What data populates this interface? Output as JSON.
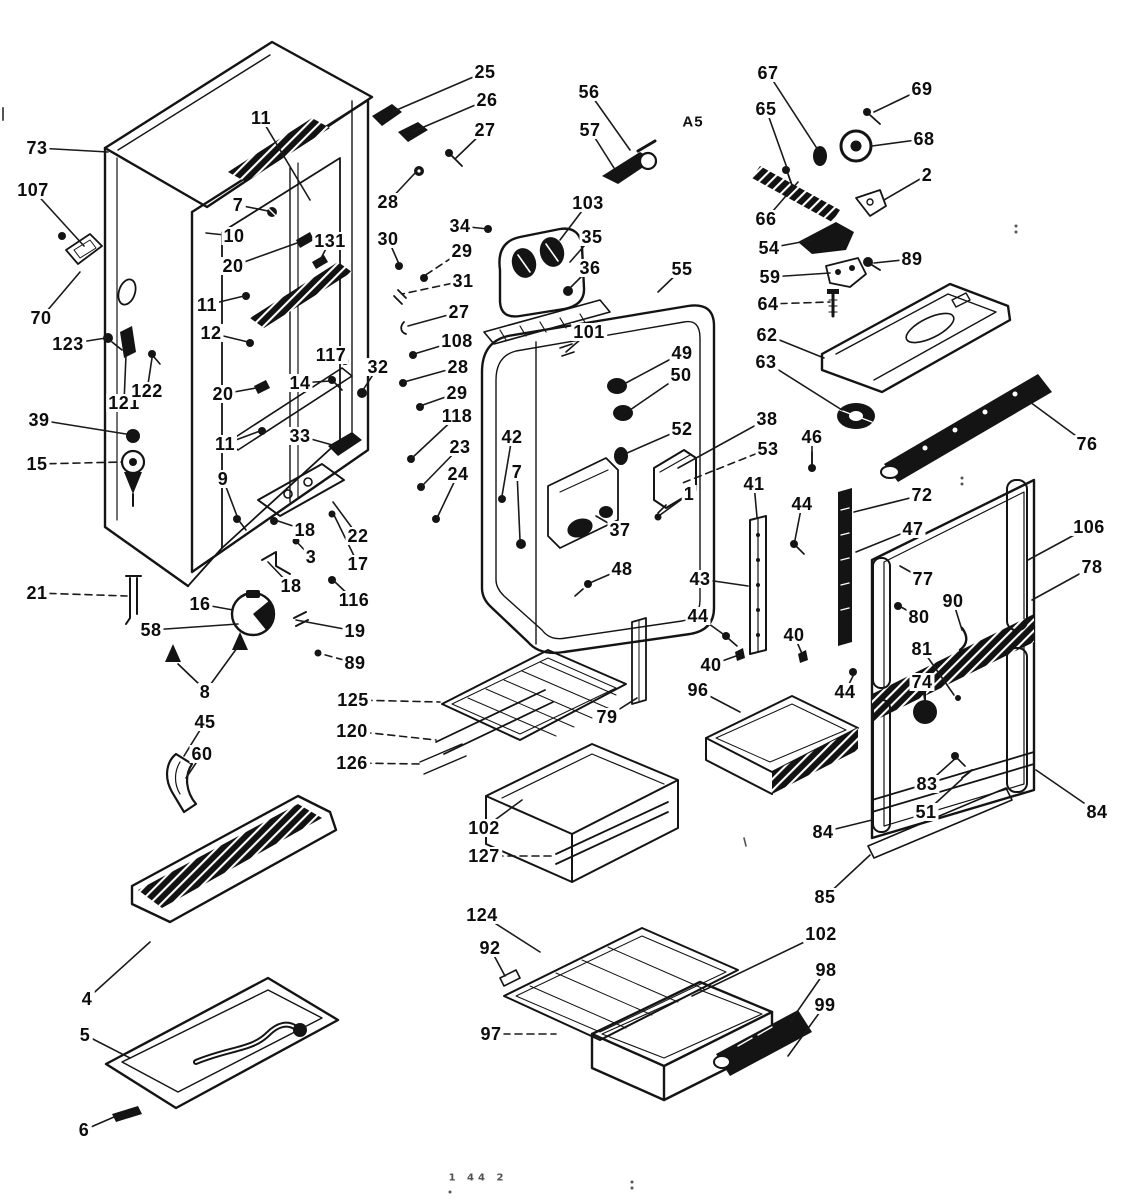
{
  "meta": {
    "sheet_code": "A5",
    "footer_note": "1 44 2",
    "description": "Refrigerator cabinet exploded parts diagram"
  },
  "diagram": {
    "labels": [
      {
        "t": "73",
        "x": 37,
        "y": 148,
        "lx": 108,
        "ly": 152,
        "d": false
      },
      {
        "t": "107",
        "x": 33,
        "y": 190,
        "lx": 84,
        "ly": 246,
        "d": false
      },
      {
        "t": "70",
        "x": 41,
        "y": 318,
        "lx": 80,
        "ly": 272,
        "d": false
      },
      {
        "t": "123",
        "x": 68,
        "y": 344,
        "lx": 106,
        "ly": 338,
        "d": false
      },
      {
        "t": "121",
        "x": 124,
        "y": 403,
        "lx": 126,
        "ly": 355,
        "d": false
      },
      {
        "t": "122",
        "x": 147,
        "y": 391,
        "lx": 152,
        "ly": 358,
        "d": false
      },
      {
        "t": "39",
        "x": 39,
        "y": 420,
        "lx": 126,
        "ly": 434,
        "d": false
      },
      {
        "t": "15",
        "x": 37,
        "y": 464,
        "lx": 122,
        "ly": 462,
        "d": true
      },
      {
        "t": "21",
        "x": 37,
        "y": 593,
        "lx": 127,
        "ly": 596,
        "d": true
      },
      {
        "t": "11",
        "x": 261,
        "y": 118,
        "lx": 310,
        "ly": 200,
        "d": false
      },
      {
        "t": "7",
        "x": 238,
        "y": 205,
        "lx": 268,
        "ly": 211,
        "d": false
      },
      {
        "t": "10",
        "x": 234,
        "y": 236,
        "lx": 206,
        "ly": 233,
        "d": false
      },
      {
        "t": "20",
        "x": 233,
        "y": 266,
        "lx": 297,
        "ly": 243,
        "d": false
      },
      {
        "t": "131",
        "x": 330,
        "y": 241,
        "lx": 318,
        "ly": 264,
        "d": false
      },
      {
        "t": "11",
        "x": 207,
        "y": 305,
        "lx": 244,
        "ly": 296,
        "d": false
      },
      {
        "t": "12",
        "x": 211,
        "y": 333,
        "lx": 248,
        "ly": 342,
        "d": false
      },
      {
        "t": "117",
        "x": 331,
        "y": 355,
        "lx": 344,
        "ly": 360,
        "d": false
      },
      {
        "t": "32",
        "x": 378,
        "y": 367,
        "lx": 363,
        "ly": 390,
        "d": false
      },
      {
        "t": "14",
        "x": 300,
        "y": 383,
        "lx": 330,
        "ly": 381,
        "d": false
      },
      {
        "t": "20",
        "x": 223,
        "y": 394,
        "lx": 256,
        "ly": 388,
        "d": false
      },
      {
        "t": "33",
        "x": 300,
        "y": 436,
        "lx": 336,
        "ly": 446,
        "d": false
      },
      {
        "t": "11",
        "x": 225,
        "y": 444,
        "lx": 260,
        "ly": 431,
        "d": false
      },
      {
        "t": "9",
        "x": 223,
        "y": 479,
        "lx": 237,
        "ly": 516,
        "d": false
      },
      {
        "t": "25",
        "x": 485,
        "y": 72,
        "lx": 392,
        "ly": 112,
        "d": false
      },
      {
        "t": "26",
        "x": 487,
        "y": 100,
        "lx": 412,
        "ly": 132,
        "d": false
      },
      {
        "t": "27",
        "x": 485,
        "y": 130,
        "lx": 456,
        "ly": 158,
        "d": false
      },
      {
        "t": "28",
        "x": 388,
        "y": 202,
        "lx": 416,
        "ly": 172,
        "d": false
      },
      {
        "t": "30",
        "x": 388,
        "y": 239,
        "lx": 399,
        "ly": 264,
        "d": false
      },
      {
        "t": "34",
        "x": 460,
        "y": 226,
        "lx": 488,
        "ly": 229,
        "d": false
      },
      {
        "t": "29",
        "x": 462,
        "y": 251,
        "lx": 424,
        "ly": 276,
        "d": true
      },
      {
        "t": "31",
        "x": 463,
        "y": 281,
        "lx": 402,
        "ly": 294,
        "d": true
      },
      {
        "t": "27",
        "x": 459,
        "y": 312,
        "lx": 408,
        "ly": 326,
        "d": false
      },
      {
        "t": "108",
        "x": 457,
        "y": 341,
        "lx": 414,
        "ly": 354,
        "d": false
      },
      {
        "t": "28",
        "x": 458,
        "y": 367,
        "lx": 404,
        "ly": 382,
        "d": false
      },
      {
        "t": "29",
        "x": 457,
        "y": 393,
        "lx": 420,
        "ly": 406,
        "d": false
      },
      {
        "t": "118",
        "x": 457,
        "y": 416,
        "lx": 412,
        "ly": 458,
        "d": false
      },
      {
        "t": "23",
        "x": 460,
        "y": 447,
        "lx": 422,
        "ly": 486,
        "d": false
      },
      {
        "t": "24",
        "x": 458,
        "y": 474,
        "lx": 437,
        "ly": 518,
        "d": false
      },
      {
        "t": "42",
        "x": 512,
        "y": 437,
        "lx": 502,
        "ly": 496,
        "d": false
      },
      {
        "t": "7",
        "x": 517,
        "y": 472,
        "lx": 520,
        "ly": 540,
        "d": false
      },
      {
        "t": "56",
        "x": 589,
        "y": 92,
        "lx": 630,
        "ly": 150,
        "d": false
      },
      {
        "t": "57",
        "x": 590,
        "y": 130,
        "lx": 614,
        "ly": 168,
        "d": false
      },
      {
        "t": "103",
        "x": 588,
        "y": 203,
        "lx": 560,
        "ly": 240,
        "d": false
      },
      {
        "t": "35",
        "x": 592,
        "y": 237,
        "lx": 570,
        "ly": 262,
        "d": false
      },
      {
        "t": "36",
        "x": 590,
        "y": 268,
        "lx": 568,
        "ly": 290,
        "d": false
      },
      {
        "t": "101",
        "x": 589,
        "y": 332,
        "lx": 566,
        "ly": 352,
        "d": false
      },
      {
        "t": "55",
        "x": 682,
        "y": 269,
        "lx": 658,
        "ly": 292,
        "d": false
      },
      {
        "t": "49",
        "x": 682,
        "y": 353,
        "lx": 624,
        "ly": 384,
        "d": false
      },
      {
        "t": "50",
        "x": 681,
        "y": 375,
        "lx": 630,
        "ly": 410,
        "d": false
      },
      {
        "t": "52",
        "x": 682,
        "y": 429,
        "lx": 627,
        "ly": 453,
        "d": false
      },
      {
        "t": "38",
        "x": 767,
        "y": 419,
        "lx": 678,
        "ly": 468,
        "d": false
      },
      {
        "t": "53",
        "x": 768,
        "y": 449,
        "lx": 680,
        "ly": 484,
        "d": true
      },
      {
        "t": "1",
        "x": 689,
        "y": 494,
        "lx": 660,
        "ly": 515,
        "d": false
      },
      {
        "t": "37",
        "x": 620,
        "y": 530,
        "lx": 596,
        "ly": 516,
        "d": false
      },
      {
        "t": "48",
        "x": 622,
        "y": 569,
        "lx": 592,
        "ly": 582,
        "d": false
      },
      {
        "t": "67",
        "x": 768,
        "y": 73,
        "lx": 818,
        "ly": 150,
        "d": false
      },
      {
        "t": "65",
        "x": 766,
        "y": 109,
        "lx": 787,
        "ly": 168,
        "d": false
      },
      {
        "t": "69",
        "x": 922,
        "y": 89,
        "lx": 874,
        "ly": 112,
        "d": false
      },
      {
        "t": "68",
        "x": 924,
        "y": 139,
        "lx": 872,
        "ly": 146,
        "d": false
      },
      {
        "t": "2",
        "x": 927,
        "y": 175,
        "lx": 884,
        "ly": 200,
        "d": false
      },
      {
        "t": "66",
        "x": 766,
        "y": 219,
        "lx": 798,
        "ly": 182,
        "d": false
      },
      {
        "t": "54",
        "x": 769,
        "y": 248,
        "lx": 812,
        "ly": 240,
        "d": false
      },
      {
        "t": "89",
        "x": 912,
        "y": 259,
        "lx": 874,
        "ly": 263,
        "d": false
      },
      {
        "t": "59",
        "x": 770,
        "y": 277,
        "lx": 830,
        "ly": 273,
        "d": false
      },
      {
        "t": "64",
        "x": 768,
        "y": 304,
        "lx": 830,
        "ly": 302,
        "d": true
      },
      {
        "t": "62",
        "x": 767,
        "y": 335,
        "lx": 824,
        "ly": 358,
        "d": false
      },
      {
        "t": "63",
        "x": 766,
        "y": 362,
        "lx": 842,
        "ly": 410,
        "d": false
      },
      {
        "t": "76",
        "x": 1087,
        "y": 444,
        "lx": 1030,
        "ly": 402,
        "d": false
      },
      {
        "t": "46",
        "x": 812,
        "y": 437,
        "lx": 812,
        "ly": 464,
        "d": false
      },
      {
        "t": "41",
        "x": 754,
        "y": 484,
        "lx": 757,
        "ly": 517,
        "d": false
      },
      {
        "t": "44",
        "x": 802,
        "y": 504,
        "lx": 795,
        "ly": 540,
        "d": false
      },
      {
        "t": "72",
        "x": 922,
        "y": 495,
        "lx": 854,
        "ly": 512,
        "d": false
      },
      {
        "t": "47",
        "x": 913,
        "y": 529,
        "lx": 856,
        "ly": 552,
        "d": false
      },
      {
        "t": "106",
        "x": 1089,
        "y": 527,
        "lx": 1028,
        "ly": 560,
        "d": false
      },
      {
        "t": "78",
        "x": 1092,
        "y": 567,
        "lx": 1032,
        "ly": 600,
        "d": false
      },
      {
        "t": "77",
        "x": 923,
        "y": 579,
        "lx": 900,
        "ly": 566,
        "d": false
      },
      {
        "t": "90",
        "x": 953,
        "y": 601,
        "lx": 962,
        "ly": 630,
        "d": false
      },
      {
        "t": "80",
        "x": 919,
        "y": 617,
        "lx": 901,
        "ly": 607,
        "d": false
      },
      {
        "t": "81",
        "x": 922,
        "y": 649,
        "lx": 954,
        "ly": 695,
        "d": false
      },
      {
        "t": "74",
        "x": 922,
        "y": 682,
        "lx": 925,
        "ly": 702,
        "d": false
      },
      {
        "t": "40",
        "x": 794,
        "y": 635,
        "lx": 803,
        "ly": 656,
        "d": false
      },
      {
        "t": "44",
        "x": 845,
        "y": 692,
        "lx": 853,
        "ly": 676,
        "d": false
      },
      {
        "t": "43",
        "x": 700,
        "y": 579,
        "lx": 748,
        "ly": 586,
        "d": false
      },
      {
        "t": "44",
        "x": 698,
        "y": 616,
        "lx": 723,
        "ly": 634,
        "d": false
      },
      {
        "t": "40",
        "x": 711,
        "y": 665,
        "lx": 736,
        "ly": 656,
        "d": false
      },
      {
        "t": "96",
        "x": 698,
        "y": 690,
        "lx": 740,
        "ly": 712,
        "d": false
      },
      {
        "t": "79",
        "x": 607,
        "y": 717,
        "lx": 637,
        "ly": 698,
        "d": false
      },
      {
        "t": "18",
        "x": 305,
        "y": 530,
        "lx": 278,
        "ly": 521,
        "d": false
      },
      {
        "t": "22",
        "x": 358,
        "y": 536,
        "lx": 333,
        "ly": 502,
        "d": false
      },
      {
        "t": "17",
        "x": 358,
        "y": 564,
        "lx": 334,
        "ly": 515,
        "d": false
      },
      {
        "t": "3",
        "x": 311,
        "y": 557,
        "lx": 296,
        "ly": 541,
        "d": false
      },
      {
        "t": "18",
        "x": 291,
        "y": 586,
        "lx": 268,
        "ly": 562,
        "d": false
      },
      {
        "t": "116",
        "x": 354,
        "y": 600,
        "lx": 334,
        "ly": 581,
        "d": false
      },
      {
        "t": "19",
        "x": 355,
        "y": 631,
        "lx": 296,
        "ly": 620,
        "d": false
      },
      {
        "t": "89",
        "x": 355,
        "y": 663,
        "lx": 318,
        "ly": 653,
        "d": true
      },
      {
        "t": "16",
        "x": 200,
        "y": 604,
        "lx": 233,
        "ly": 610,
        "d": false
      },
      {
        "t": "58",
        "x": 151,
        "y": 630,
        "lx": 238,
        "ly": 624,
        "d": false
      },
      {
        "t": "8",
        "x": 205,
        "y": 692,
        "lx": 237,
        "ly": 648,
        "d": false
      },
      {
        "t": "45",
        "x": 205,
        "y": 722,
        "lx": 184,
        "ly": 756,
        "d": false
      },
      {
        "t": "60",
        "x": 202,
        "y": 754,
        "lx": 186,
        "ly": 778,
        "d": false
      },
      {
        "t": "125",
        "x": 353,
        "y": 700,
        "lx": 440,
        "ly": 702,
        "d": true
      },
      {
        "t": "120",
        "x": 352,
        "y": 731,
        "lx": 436,
        "ly": 740,
        "d": true
      },
      {
        "t": "126",
        "x": 352,
        "y": 763,
        "lx": 420,
        "ly": 764,
        "d": true
      },
      {
        "t": "102",
        "x": 484,
        "y": 828,
        "lx": 522,
        "ly": 800,
        "d": false
      },
      {
        "t": "127",
        "x": 484,
        "y": 856,
        "lx": 556,
        "ly": 856,
        "d": true
      },
      {
        "t": "124",
        "x": 482,
        "y": 915,
        "lx": 540,
        "ly": 952,
        "d": false
      },
      {
        "t": "92",
        "x": 490,
        "y": 948,
        "lx": 505,
        "ly": 976,
        "d": false
      },
      {
        "t": "97",
        "x": 491,
        "y": 1034,
        "lx": 556,
        "ly": 1034,
        "d": true
      },
      {
        "t": "4",
        "x": 87,
        "y": 999,
        "lx": 150,
        "ly": 942,
        "d": false
      },
      {
        "t": "5",
        "x": 85,
        "y": 1035,
        "lx": 130,
        "ly": 1058,
        "d": false
      },
      {
        "t": "6",
        "x": 84,
        "y": 1130,
        "lx": 114,
        "ly": 1117,
        "d": false
      },
      {
        "t": "84",
        "x": 823,
        "y": 832,
        "lx": 872,
        "ly": 820,
        "d": false
      },
      {
        "t": "85",
        "x": 825,
        "y": 897,
        "lx": 870,
        "ly": 855,
        "d": false
      },
      {
        "t": "102",
        "x": 821,
        "y": 934,
        "lx": 692,
        "ly": 996,
        "d": false
      },
      {
        "t": "98",
        "x": 826,
        "y": 970,
        "lx": 790,
        "ly": 1022,
        "d": false
      },
      {
        "t": "99",
        "x": 825,
        "y": 1005,
        "lx": 788,
        "ly": 1056,
        "d": false
      },
      {
        "t": "84",
        "x": 1097,
        "y": 812,
        "lx": 1036,
        "ly": 770,
        "d": false
      },
      {
        "t": "51",
        "x": 926,
        "y": 812,
        "lx": 962,
        "ly": 779,
        "d": false
      },
      {
        "t": "83",
        "x": 927,
        "y": 784,
        "lx": 957,
        "ly": 757,
        "d": false
      }
    ]
  }
}
